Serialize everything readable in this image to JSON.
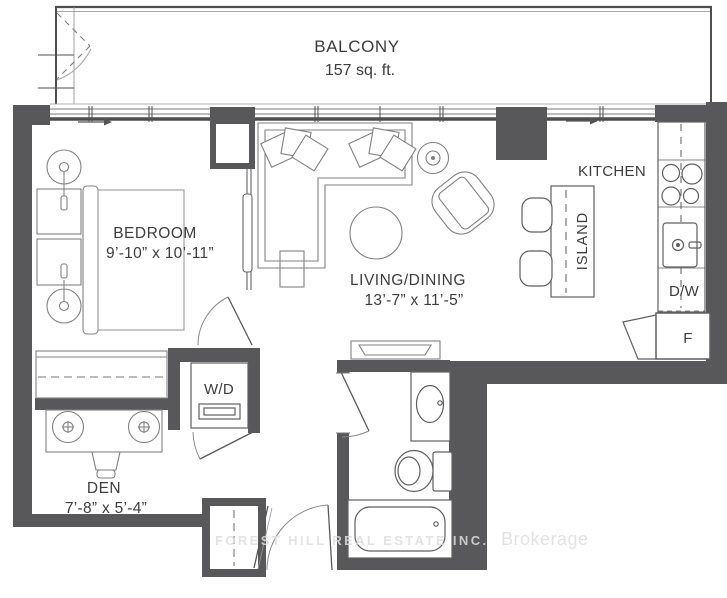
{
  "plan": {
    "balcony": {
      "name": "BALCONY",
      "area": "157 sq. ft."
    },
    "bedroom": {
      "name": "BEDROOM",
      "dims": "9’-10” x 10’-11”"
    },
    "living_dining": {
      "name": "LIVING/DINING",
      "dims": "13’-7” x 11’-5”"
    },
    "kitchen": {
      "name": "KITCHEN"
    },
    "island": {
      "name": "ISLAND"
    },
    "den": {
      "name": "DEN",
      "dims": "7’-8” x 5’-4”"
    },
    "washer_dryer": {
      "label": "W/D"
    },
    "dishwasher": {
      "label": "D/W"
    },
    "fridge": {
      "label": "F"
    }
  },
  "watermark": {
    "brand": "FOREST HILL REAL ESTATE INC.",
    "suffix": "Brokerage"
  },
  "colors": {
    "background": "#ffffff",
    "wall": "#58585a",
    "window_line": "#4f4f4f",
    "furniture_line": "#828282",
    "fixture_line": "#5f5f5f",
    "text": "#3d3d3d",
    "watermark": "#dedede"
  }
}
